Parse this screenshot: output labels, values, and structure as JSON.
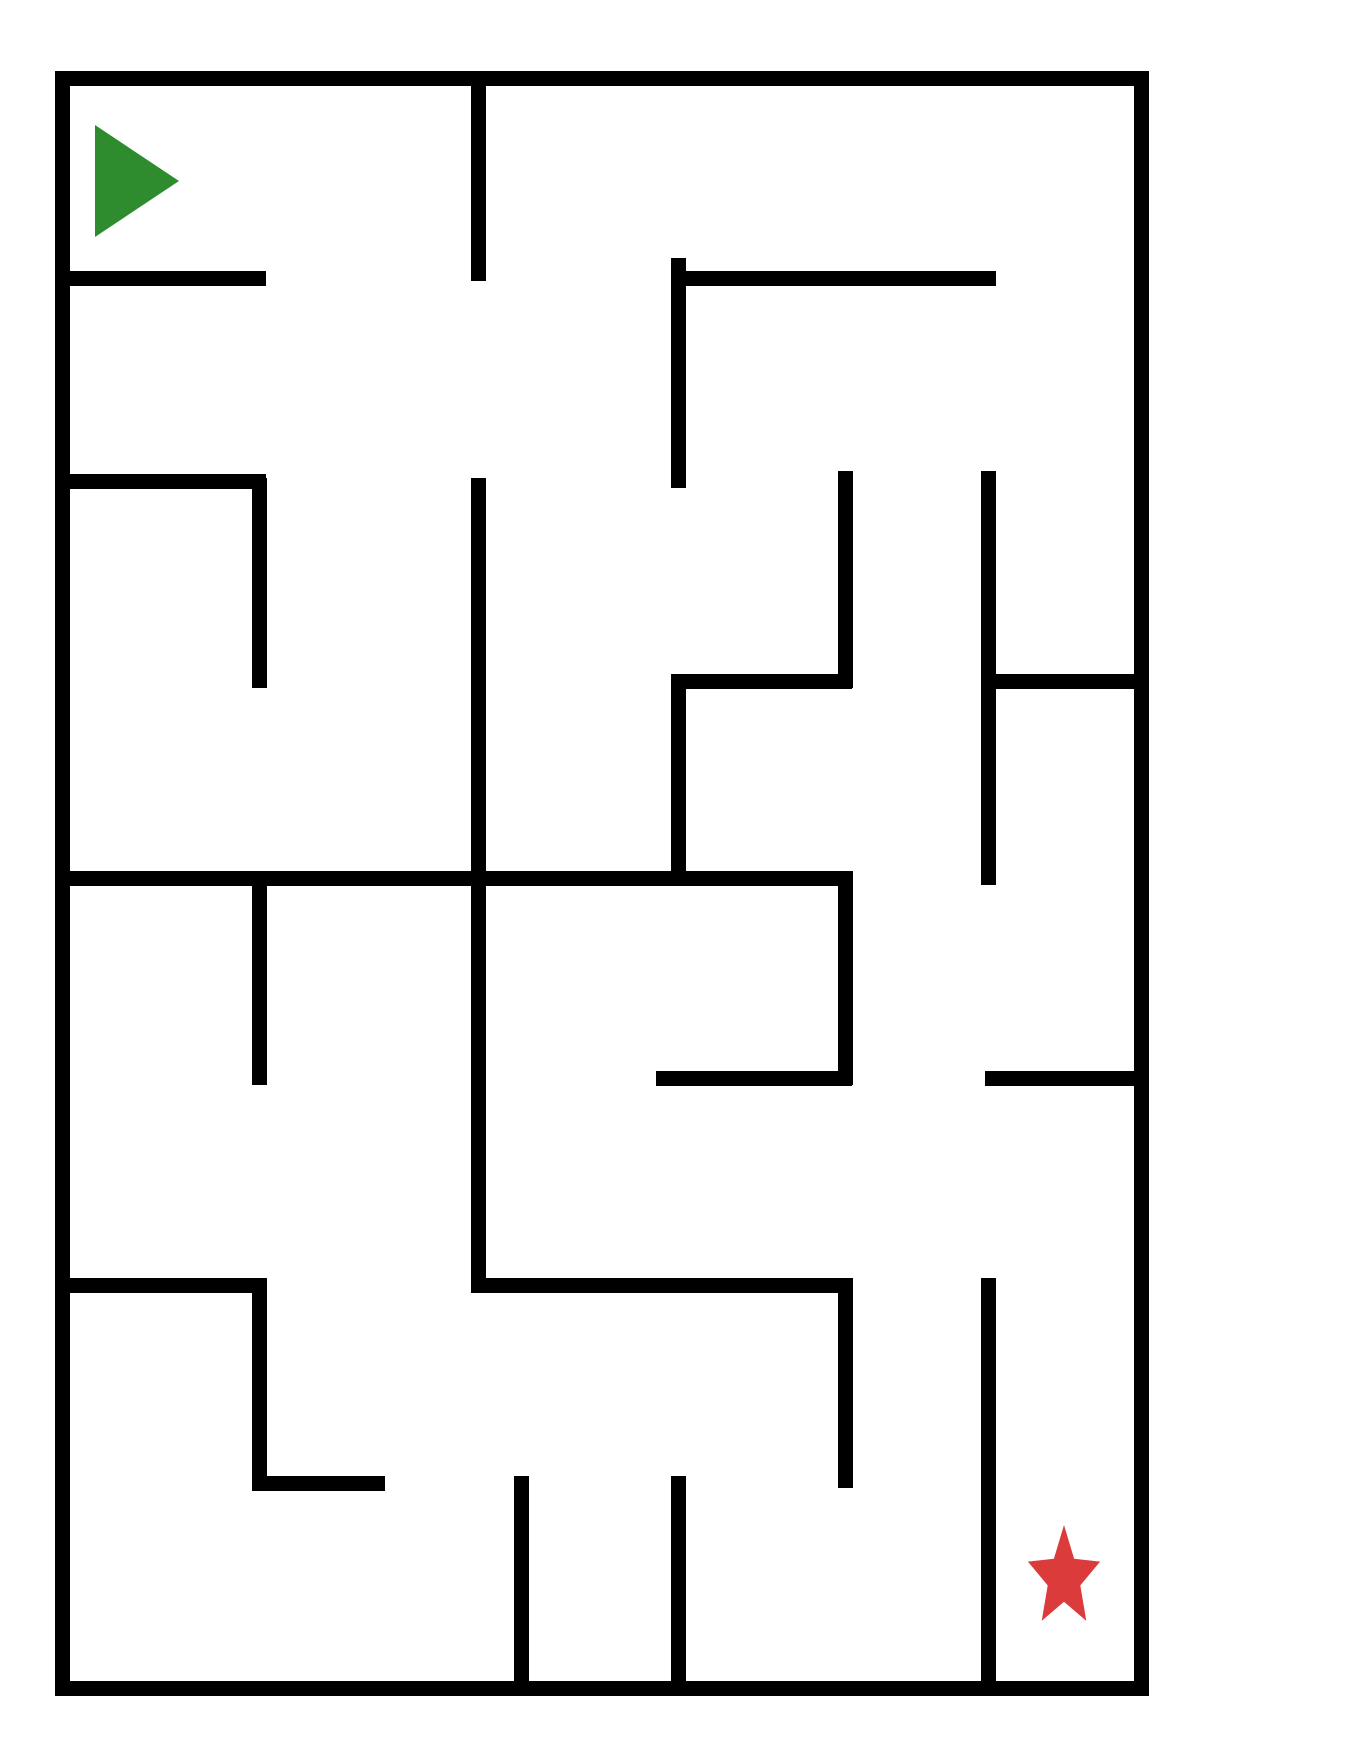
{
  "title": "Maze puzzle with start arrow and goal star",
  "canvas": {
    "width": 1360,
    "height": 1760,
    "background": "#ffffff"
  },
  "maze": {
    "wall_color": "#000000",
    "wall_thickness": 15,
    "h_walls": [
      {
        "name": "border-top",
        "y": 78,
        "x1": 55,
        "x2": 1148
      },
      {
        "name": "border-bottom",
        "y": 1688,
        "x1": 55,
        "x2": 1148
      },
      {
        "name": "h-row1-left",
        "y": 278,
        "x1": 62,
        "x2": 266
      },
      {
        "name": "h-row1-right",
        "y": 278,
        "x1": 671,
        "x2": 996
      },
      {
        "name": "h-row2-left",
        "y": 481,
        "x1": 62,
        "x2": 266
      },
      {
        "name": "h-row3-mid",
        "y": 681,
        "x1": 671,
        "x2": 852
      },
      {
        "name": "h-row3-right",
        "y": 681,
        "x1": 985,
        "x2": 1148
      },
      {
        "name": "h-row4-long",
        "y": 878,
        "x1": 62,
        "x2": 852
      },
      {
        "name": "h-row5-mid",
        "y": 1078,
        "x1": 656,
        "x2": 852
      },
      {
        "name": "h-row5-right",
        "y": 1078,
        "x1": 985,
        "x2": 1148
      },
      {
        "name": "h-row6-left",
        "y": 1285,
        "x1": 62,
        "x2": 266
      },
      {
        "name": "h-row6-mid",
        "y": 1285,
        "x1": 471,
        "x2": 852
      },
      {
        "name": "h-row7-left",
        "y": 1483,
        "x1": 252,
        "x2": 385
      }
    ],
    "v_walls": [
      {
        "name": "border-left",
        "x": 62,
        "y1": 71,
        "y2": 1696
      },
      {
        "name": "border-right",
        "x": 1141,
        "y1": 71,
        "y2": 1696
      },
      {
        "name": "v-top-middle",
        "x": 478,
        "y1": 71,
        "y2": 281
      },
      {
        "name": "v-center-long",
        "x": 478,
        "y1": 478,
        "y2": 1292
      },
      {
        "name": "v-left-a",
        "x": 259,
        "y1": 478,
        "y2": 688
      },
      {
        "name": "v-left-b",
        "x": 259,
        "y1": 871,
        "y2": 1085
      },
      {
        "name": "v-left-c",
        "x": 259,
        "y1": 1278,
        "y2": 1490
      },
      {
        "name": "v-bottom-mid",
        "x": 521,
        "y1": 1476,
        "y2": 1696
      },
      {
        "name": "v-col4-a",
        "x": 678,
        "y1": 258,
        "y2": 488
      },
      {
        "name": "v-col4-b",
        "x": 678,
        "y1": 674,
        "y2": 885
      },
      {
        "name": "v-col4-c",
        "x": 678,
        "y1": 1476,
        "y2": 1696
      },
      {
        "name": "v-col5-a",
        "x": 845,
        "y1": 471,
        "y2": 688
      },
      {
        "name": "v-col5-b",
        "x": 845,
        "y1": 871,
        "y2": 1085
      },
      {
        "name": "v-col5-c",
        "x": 845,
        "y1": 1278,
        "y2": 1488
      },
      {
        "name": "v-col6-a",
        "x": 988,
        "y1": 471,
        "y2": 885
      },
      {
        "name": "v-col6-b",
        "x": 988,
        "y1": 1278,
        "y2": 1696
      }
    ]
  },
  "start_marker": {
    "shape": "right-pointing-triangle",
    "color": "#2e8c2e",
    "x": 95,
    "y": 125,
    "width": 84,
    "height": 112
  },
  "goal_marker": {
    "shape": "five-point-star",
    "color": "#db3b3b",
    "cx": 1064,
    "cy": 1578,
    "outer_rx": 38,
    "outer_ry": 53,
    "inner_ratio": 0.45
  }
}
